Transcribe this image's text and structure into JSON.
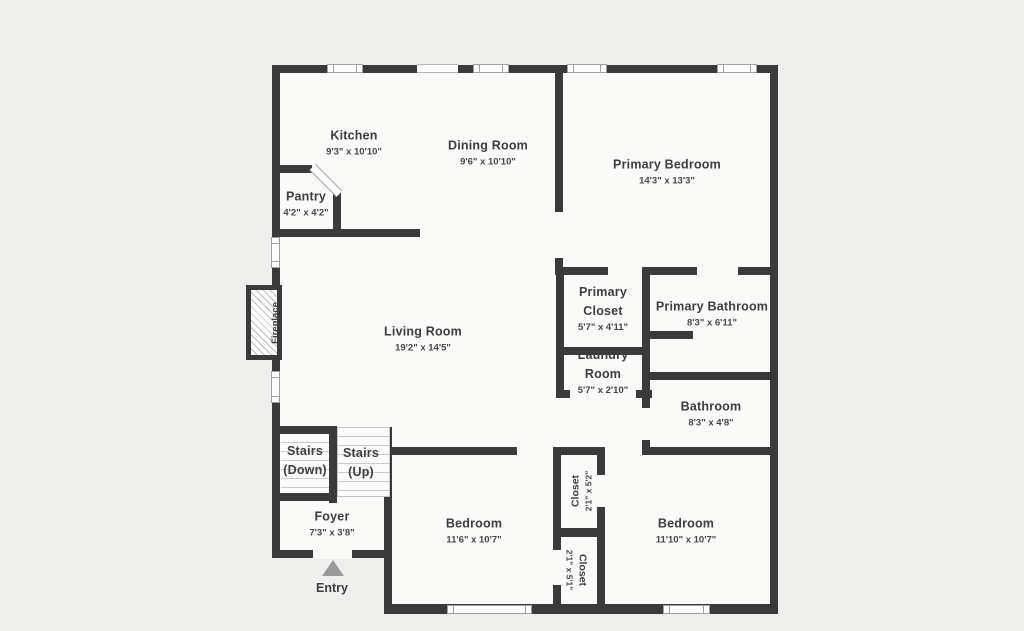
{
  "figure_type": "residential-floor-plan",
  "colors": {
    "wall": "#3a3a3a",
    "floor": "#fafaf9",
    "background": "#eff0ee",
    "text": "#3e3e3e",
    "window_line": "#a0a0a0",
    "stair_tread": "#cccccc",
    "entry_arrow": "#9b9b9b",
    "fireplace_hatch": "#bdbdbd"
  },
  "rooms": [
    {
      "id": "kitchen",
      "name": "Kitchen",
      "dims": "9'3\" x 10'10\"",
      "x": 354,
      "y": 142
    },
    {
      "id": "dining-room",
      "name": "Dining Room",
      "dims": "9'6\" x 10'10\"",
      "x": 488,
      "y": 152
    },
    {
      "id": "primary-bedroom",
      "name": "Primary Bedroom",
      "dims": "14'3\" x 13'3\"",
      "x": 667,
      "y": 171
    },
    {
      "id": "pantry",
      "name": "Pantry",
      "dims": "4'2\" x 4'2\"",
      "x": 306,
      "y": 203
    },
    {
      "id": "living-room",
      "name": "Living Room",
      "dims": "19'2\" x 14'5\"",
      "x": 423,
      "y": 338
    },
    {
      "id": "primary-closet",
      "name": "Primary\nCloset",
      "dims": "5'7\" x 4'11\"",
      "x": 603,
      "y": 308
    },
    {
      "id": "primary-bathroom",
      "name": "Primary Bathroom",
      "dims": "8'3\" x 6'11\"",
      "x": 712,
      "y": 313
    },
    {
      "id": "laundry-room",
      "name": "Laundry\nRoom",
      "dims": "5'7\" x 2'10\"",
      "x": 603,
      "y": 371
    },
    {
      "id": "bathroom",
      "name": "Bathroom",
      "dims": "8'3\" x 4'8\"",
      "x": 711,
      "y": 413
    },
    {
      "id": "stairs-down",
      "name": "Stairs\n(Down)",
      "dims": "",
      "x": 305,
      "y": 461
    },
    {
      "id": "stairs-up",
      "name": "Stairs\n(Up)",
      "dims": "",
      "x": 361,
      "y": 463
    },
    {
      "id": "foyer",
      "name": "Foyer",
      "dims": "7'3\" x 3'8\"",
      "x": 332,
      "y": 523
    },
    {
      "id": "bedroom-left",
      "name": "Bedroom",
      "dims": "11'6\" x 10'7\"",
      "x": 474,
      "y": 530
    },
    {
      "id": "bedroom-right",
      "name": "Bedroom",
      "dims": "11'10\" x 10'7\"",
      "x": 686,
      "y": 530
    }
  ],
  "vertical_labels": [
    {
      "id": "closet-top",
      "name": "Closet",
      "dims": "2'1\" x 5'2\"",
      "x": 579,
      "y": 491,
      "rotate": -90
    },
    {
      "id": "closet-bottom",
      "name": "Closet",
      "dims": "2'1\" x 5'1\"",
      "x": 579,
      "y": 570,
      "rotate": 90
    }
  ],
  "fireplace": {
    "label": "Fireplace"
  },
  "entry": {
    "label": "Entry",
    "arrow": "up-triangle"
  }
}
